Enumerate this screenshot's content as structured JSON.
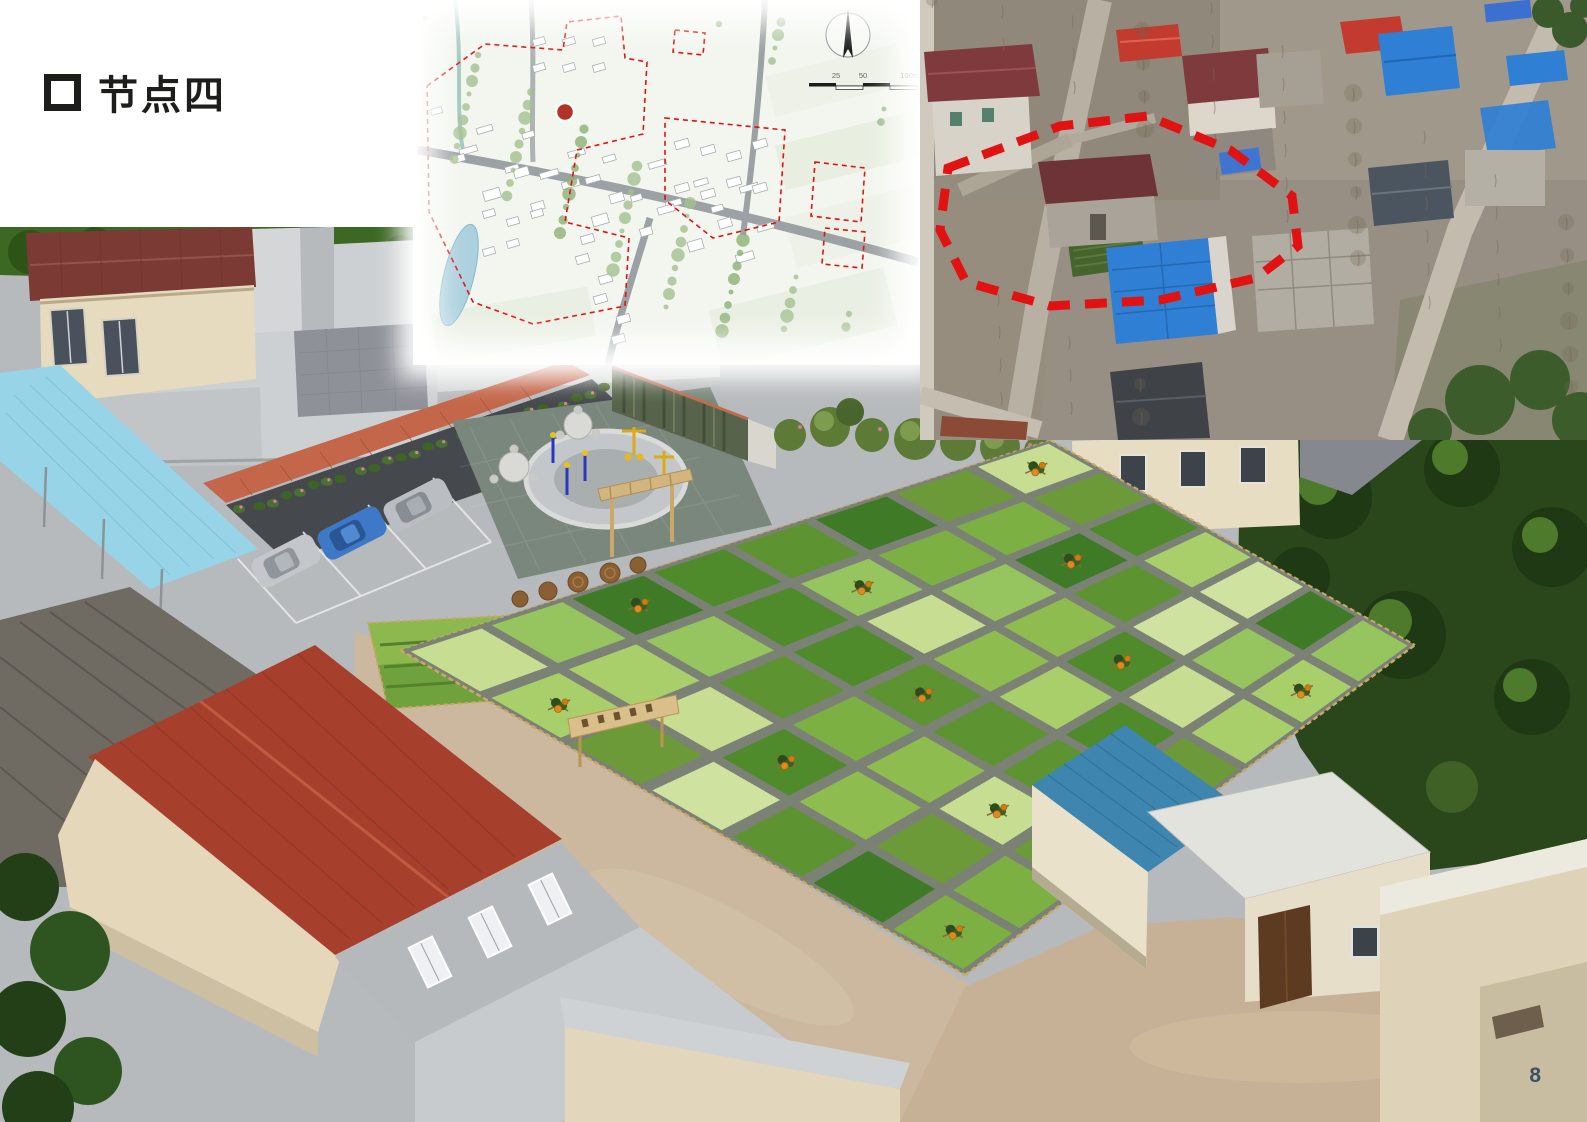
{
  "slide": {
    "title_bullet": "□",
    "title": "节点四",
    "page_number": "8"
  },
  "site_plan": {
    "scale_labels": [
      "25",
      "50",
      "100m"
    ],
    "icons": {
      "compass": "north-arrow-icon",
      "marker": "site-location-marker",
      "boundary": "red-dashed-planning-boundary"
    }
  },
  "aerial_photo": {
    "icons": {
      "boundary": "red-dashed-site-boundary"
    }
  },
  "render_scene": {
    "parked_cars": [
      "silver",
      "blue",
      "silver"
    ],
    "features": [
      "fitness-plaza",
      "parking-lot",
      "vine-covered-barn",
      "vegetable-garden-grid",
      "wooden-sign",
      "pergola-gate",
      "woven-mats",
      "blue-roof-shed",
      "village-houses"
    ]
  },
  "garden": {
    "rows": 7,
    "cols": 8,
    "corners": {
      "left": [
        400,
        423
      ],
      "top": [
        1050,
        213
      ],
      "right": [
        1415,
        418
      ],
      "bottom": [
        965,
        748
      ]
    },
    "palette": [
      "#c6dd92",
      "#8fbc4f",
      "#a9cf6b",
      "#4f8a2b",
      "#6d9a38",
      "#3f7a26",
      "#d0e2a0",
      "#7cb043",
      "#5e9331",
      "#96c45e"
    ],
    "pumpkin_cells": [
      [
        0,
        1
      ],
      [
        2,
        0
      ],
      [
        4,
        1
      ],
      [
        7,
        0
      ],
      [
        1,
        3
      ],
      [
        3,
        3
      ],
      [
        6,
        2
      ],
      [
        2,
        5
      ],
      [
        5,
        4
      ],
      [
        0,
        6
      ],
      [
        3,
        6
      ],
      [
        6,
        6
      ]
    ]
  },
  "colors": {
    "boundary_red": "#e01212",
    "marker_red": "#b13226",
    "title_text": "#1d1d1b",
    "page_number": "#3d4f63",
    "concrete": "#b7babc",
    "path_tan": "#cbb89e",
    "lawn_dark": "#2a461b",
    "gravel": "#7c8176",
    "roof_maroon": "#7c3a35",
    "roof_red": "#a6402d",
    "roof_blue": "#3e86b0",
    "canopy_blue": "#97d4e8",
    "canopy_terracotta": "#c4664a",
    "aerial_roof_blue": "#2f7fd4",
    "aerial_roof_red": "#c23b2e",
    "aerial_roof_maroon": "#7e3a3d",
    "plan_road": "#9ba1a4",
    "plan_water": "#a9cfdd"
  }
}
